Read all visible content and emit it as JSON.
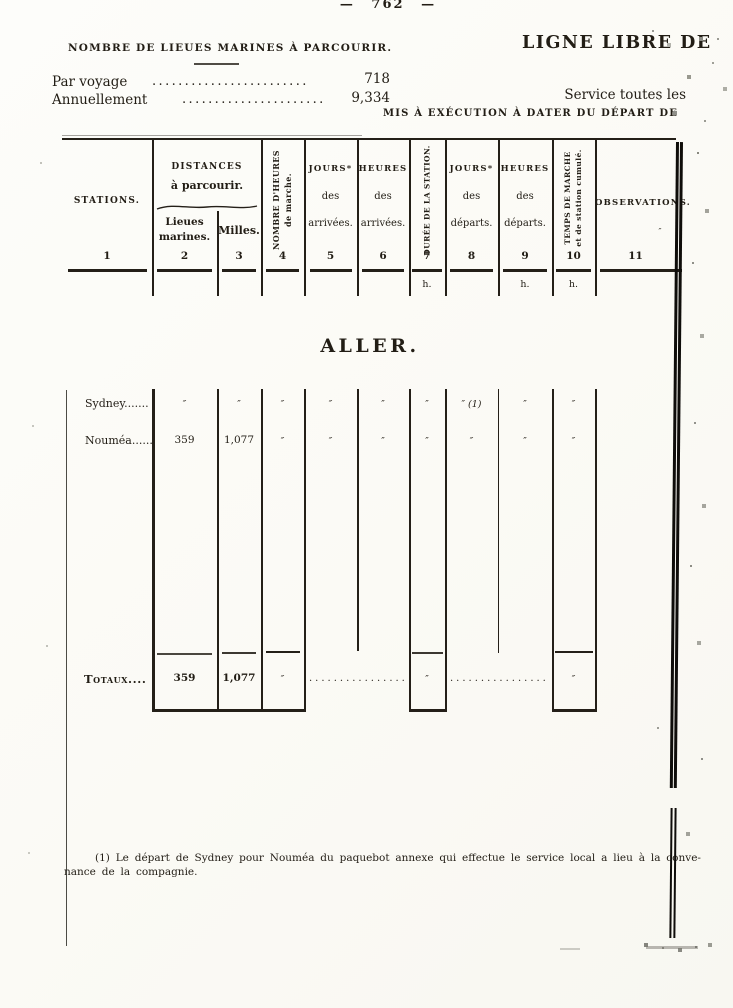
{
  "page": {
    "number": "— 762 —",
    "left_heading": "NOMBRE DE LIEUES MARINES À PARCOURIR.",
    "right_title": "LIGNE LIBRE DE",
    "stats": [
      {
        "label": "Par voyage",
        "leader": "........................",
        "value": "718"
      },
      {
        "label": "Annuellement",
        "leader": "......................",
        "value": "9,334"
      }
    ],
    "service_note": "Service toutes les",
    "execution_note": "MIS À EXÉCUTION À DATER DU DÉPART DE"
  },
  "table": {
    "distances_group": {
      "line1": "DISTANCES",
      "line2": "à parcourir."
    },
    "columns": [
      {
        "num": "1",
        "l1": "STATIONS."
      },
      {
        "num": "2",
        "l1": "Lieues",
        "l2": "marines."
      },
      {
        "num": "3",
        "l1": "Milles."
      },
      {
        "num": "4",
        "r1": "NOMBRE D'HEURES",
        "r2": "de marche."
      },
      {
        "num": "5",
        "l1": "JOURS*",
        "l2": "des",
        "l3": "arrivées."
      },
      {
        "num": "6",
        "l1": "HEURES",
        "l2": "des",
        "l3": "arrivées."
      },
      {
        "num": "7",
        "r1": "DURÉE DE LA STATION.",
        "unit": "h."
      },
      {
        "num": "8",
        "l1": "JOURS*",
        "l2": "des",
        "l3": "départs."
      },
      {
        "num": "9",
        "l1": "HEURES",
        "l2": "des",
        "l3": "départs.",
        "unit": "h."
      },
      {
        "num": "10",
        "r1": "TEMPS DE MARCHE",
        "r2": "et de station cumulé.",
        "unit": "h."
      },
      {
        "num": "11",
        "l1": "OBSERVATIONS.",
        "mark": "″"
      }
    ],
    "section_title": "ALLER.",
    "rows": [
      {
        "label": "Sydney.......",
        "c2": "″",
        "c3": "″",
        "c4": "″",
        "c5": "″",
        "c6": "″",
        "c7": "″",
        "c8": "″ (1)",
        "c9": "″",
        "c10": "″"
      },
      {
        "label": "Nouméa......",
        "c2": "359",
        "c3": "1,077",
        "c4": "″",
        "c5": "″",
        "c6": "″",
        "c7": "″",
        "c8": "″",
        "c9": "″",
        "c10": "″"
      }
    ],
    "totals": {
      "label": "Totaux....",
      "c2": "359",
      "c3": "1,077",
      "c4": "″",
      "leader_a": "..................",
      "c7": "″",
      "leader_b": "..................",
      "c10": "″"
    }
  },
  "footnote": {
    "line1": "(1) Le départ de Sydney pour Nouméa du paquebot annexe qui effectue le service local a lieu à la conve-",
    "line2": "nance de la compagnie."
  }
}
